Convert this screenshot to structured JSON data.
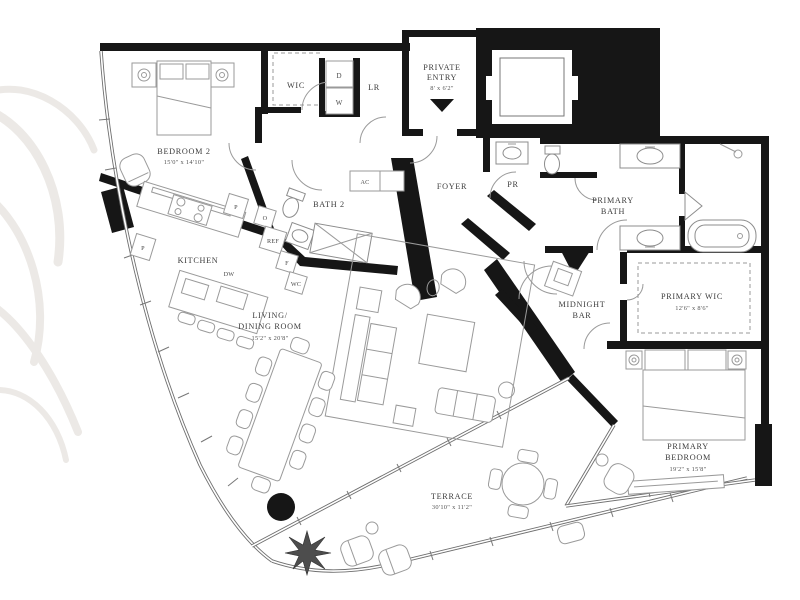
{
  "floorplan": {
    "type": "residential-floor-plan",
    "colors": {
      "wall": "#161616",
      "furniture_line": "#9a9a9a",
      "label": "#3d3d3d",
      "watermark": "#e9e6e2",
      "background": "#ffffff"
    },
    "rooms": {
      "bedroom2": {
        "name": "BEDROOM 2",
        "dims": "15'0\" x 14'10\""
      },
      "wic": {
        "name": "WIC"
      },
      "laundry": {
        "dryer": "D",
        "washer": "W"
      },
      "lr": {
        "name": "LR"
      },
      "private_entry": {
        "name_line1": "PRIVATE",
        "name_line2": "ENTRY",
        "dims": "8' x 6'2\""
      },
      "foyer": {
        "name": "FOYER"
      },
      "powder_room": {
        "name": "PR"
      },
      "ac_closet": {
        "name": "AC"
      },
      "bath2": {
        "name": "BATH 2"
      },
      "kitchen": {
        "name": "KITCHEN",
        "appliances": {
          "pantry1": "P",
          "pantry2": "P",
          "oven": "O",
          "refrigerator": "REF",
          "freezer": "F",
          "wine_cooler": "WC",
          "dishwasher": "DW"
        }
      },
      "living_dining": {
        "name_line1": "LIVING/",
        "name_line2": "DINING ROOM",
        "dims": "15'2\" x 20'8\""
      },
      "midnight_bar": {
        "name_line1": "MIDNIGHT",
        "name_line2": "BAR"
      },
      "primary_bath": {
        "name_line1": "PRIMARY",
        "name_line2": "BATH"
      },
      "primary_wic": {
        "name": "PRIMARY WIC",
        "dims": "12'6\" x 8'6\""
      },
      "primary_bedroom": {
        "name_line1": "PRIMARY",
        "name_line2": "BEDROOM",
        "dims": "19'2\" x 15'8\""
      },
      "terrace": {
        "name": "TERRACE",
        "dims": "30'10\" x 11'2\""
      }
    }
  }
}
